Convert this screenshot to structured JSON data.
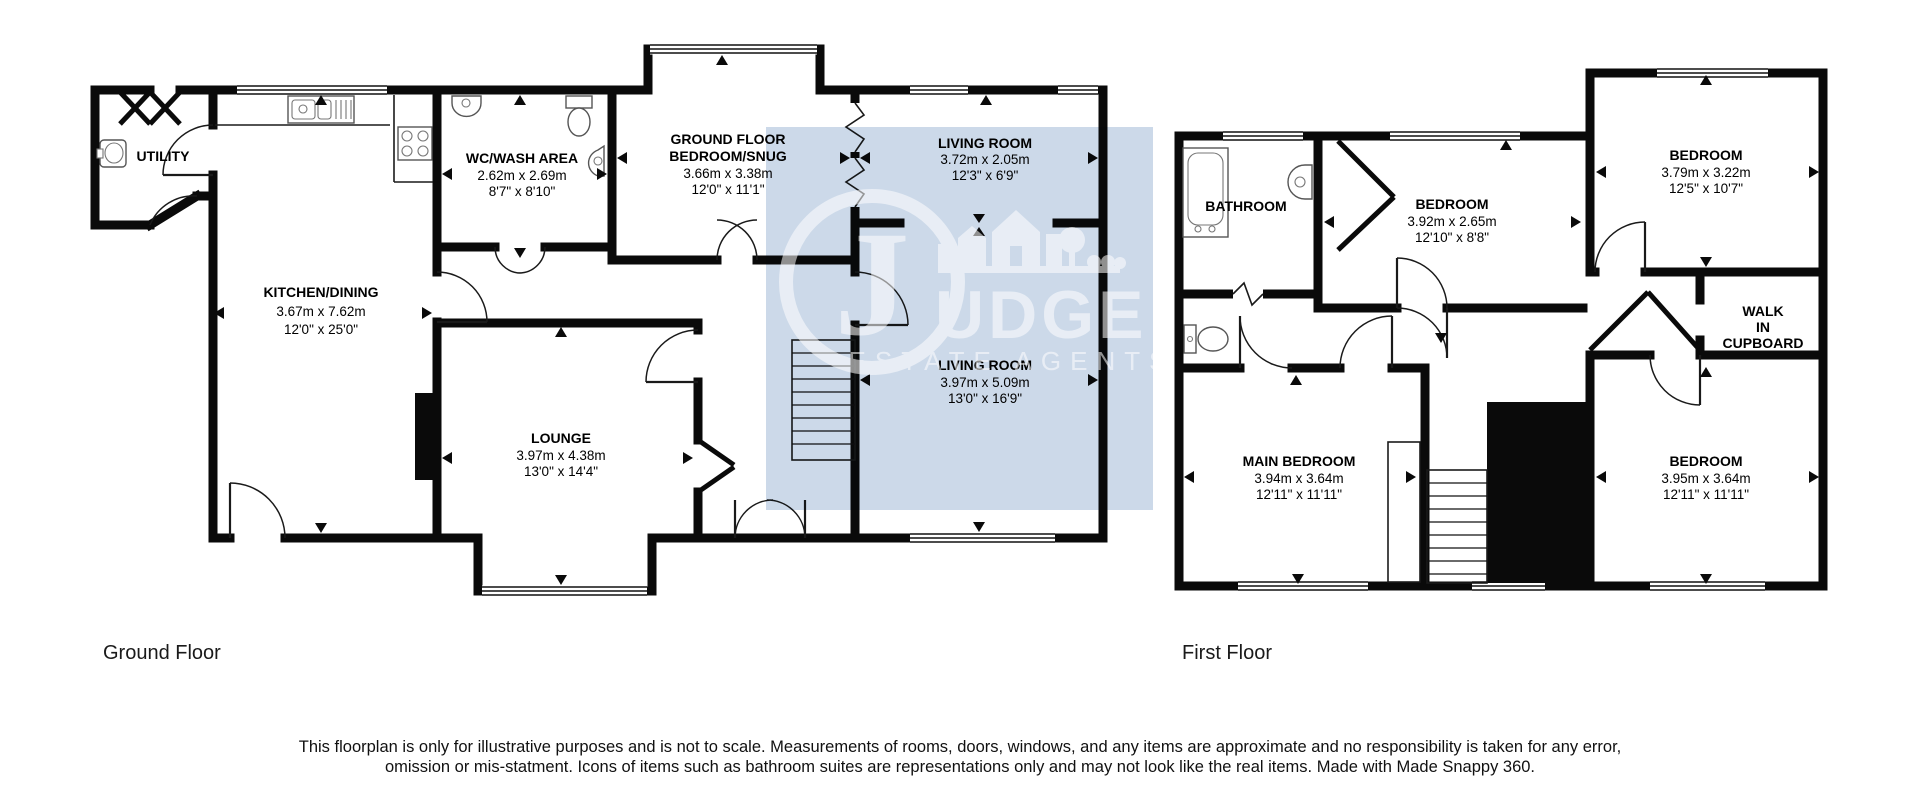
{
  "ground_floor": {
    "label": "Ground Floor",
    "rooms": {
      "utility": {
        "name": "UTILITY"
      },
      "kitchen": {
        "name": "KITCHEN/DINING",
        "metric": "3.67m x 7.62m",
        "imperial": "12'0\" x 25'0\""
      },
      "wc": {
        "name": "WC/WASH AREA",
        "metric": "2.62m x 2.69m",
        "imperial": "8'7\" x 8'10\""
      },
      "snug": {
        "name_line1": "GROUND FLOOR",
        "name_line2": "BEDROOM/SNUG",
        "metric": "3.66m x 3.38m",
        "imperial": "12'0\" x 11'1\""
      },
      "living_small": {
        "name": "LIVING ROOM",
        "metric": "3.72m x 2.05m",
        "imperial": "12'3\" x 6'9\""
      },
      "living_large": {
        "name": "LIVING ROOM",
        "metric": "3.97m x 5.09m",
        "imperial": "13'0\" x 16'9\""
      },
      "lounge": {
        "name": "LOUNGE",
        "metric": "3.97m x 4.38m",
        "imperial": "13'0\" x 14'4\""
      }
    }
  },
  "first_floor": {
    "label": "First Floor",
    "rooms": {
      "bathroom": {
        "name": "BATHROOM"
      },
      "bedroom_mid": {
        "name": "BEDROOM",
        "metric": "3.92m x 2.65m",
        "imperial": "12'10\" x 8'8\""
      },
      "bedroom_top_right": {
        "name": "BEDROOM",
        "metric": "3.79m x 3.22m",
        "imperial": "12'5\" x 10'7\""
      },
      "walk_in_cupboard": {
        "line1": "WALK",
        "line2": "IN",
        "line3": "CUPBOARD"
      },
      "main_bedroom": {
        "name": "MAIN BEDROOM",
        "metric": "3.94m x 3.64m",
        "imperial": "12'11\" x 11'11\""
      },
      "bedroom_bottom_right": {
        "name": "BEDROOM",
        "metric": "3.95m x 3.64m",
        "imperial": "12'11\" x 11'11\""
      }
    }
  },
  "watermark": {
    "initial": "J",
    "brand_rest": "UDGE",
    "tagline": "ESTATE AGENTS",
    "panel_color": "#ccd9e9",
    "logo_color": "#ffffff"
  },
  "colors": {
    "wall": "#0a0a0a",
    "background": "#ffffff"
  },
  "disclaimer": "This floorplan is only for illustrative purposes and is not to scale. Measurements of rooms, doors, windows, and any items are approximate and no responsibility is taken for any error, omission or mis-statment. Icons of items such as bathroom suites are representations only and may not look like the real items. Made with Made Snappy 360."
}
